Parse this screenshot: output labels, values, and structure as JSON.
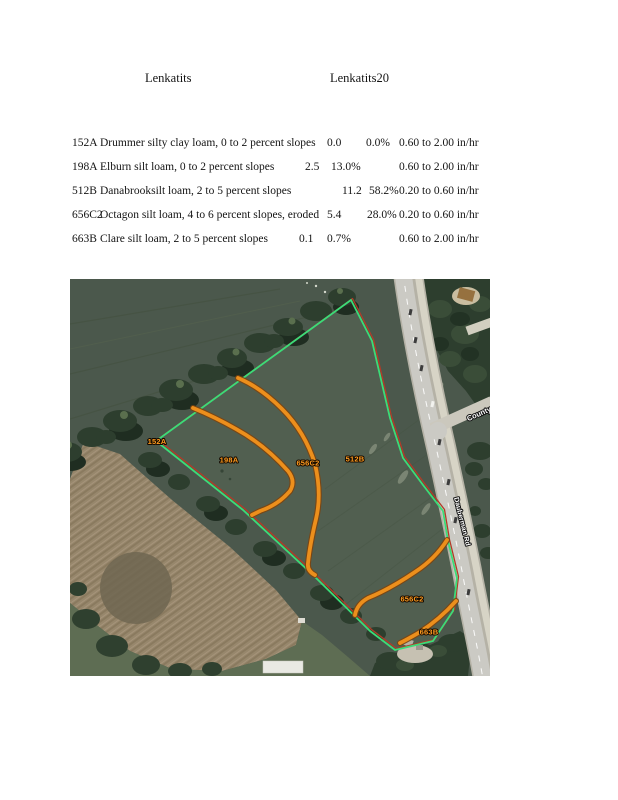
{
  "page": {
    "title1": "Lenkatits",
    "title2": "Lenkatits20"
  },
  "soil_table": {
    "rows": [
      {
        "code": "152A",
        "description": "Drummer silty clay loam, 0 to 2 percent slopes",
        "acres": "0.0",
        "percent": "0.0%",
        "rate": "0.60 to 2.00 in/hr"
      },
      {
        "code": "198A",
        "description": "Elburn silt loam, 0 to 2 percent slopes",
        "acres": "2.5",
        "percent": "13.0%",
        "rate": "0.60 to 2.00 in/hr"
      },
      {
        "code": "512B",
        "description": "Danabrooksilt loam, 2 to 5 percent slopes",
        "acres": "11.2",
        "percent": "58.2%",
        "rate": "0.20 to 0.60 in/hr"
      },
      {
        "code": "656C2",
        "description": "Octagon silt loam, 4 to 6 percent slopes, eroded",
        "acres": "5.4",
        "percent": "28.0%",
        "rate": "0.20 to 0.60 in/hr"
      },
      {
        "code": "663B",
        "description": "Clare silt loam, 2 to 5 percent slopes",
        "acres": "0.1",
        "percent": "0.7%",
        "rate": "0.60 to 2.00 in/hr"
      }
    ]
  },
  "map": {
    "region_labels": [
      {
        "id": "152A",
        "text": "152A"
      },
      {
        "id": "198A",
        "text": "198A"
      },
      {
        "id": "656C2-upper",
        "text": "656C2"
      },
      {
        "id": "512B",
        "text": "512B"
      },
      {
        "id": "656C2-lower",
        "text": "656C2"
      },
      {
        "id": "663B",
        "text": "663B"
      }
    ],
    "road_labels": [
      {
        "id": "county",
        "text": "County"
      },
      {
        "id": "dauberman",
        "text": "Dauberman Rd"
      }
    ],
    "colors": {
      "boundary_green": "#3bdc78",
      "boundary_red": "#b23b27",
      "soil_line_orange": "#ec8f1c",
      "label_orange": "#ff9b1f"
    }
  }
}
